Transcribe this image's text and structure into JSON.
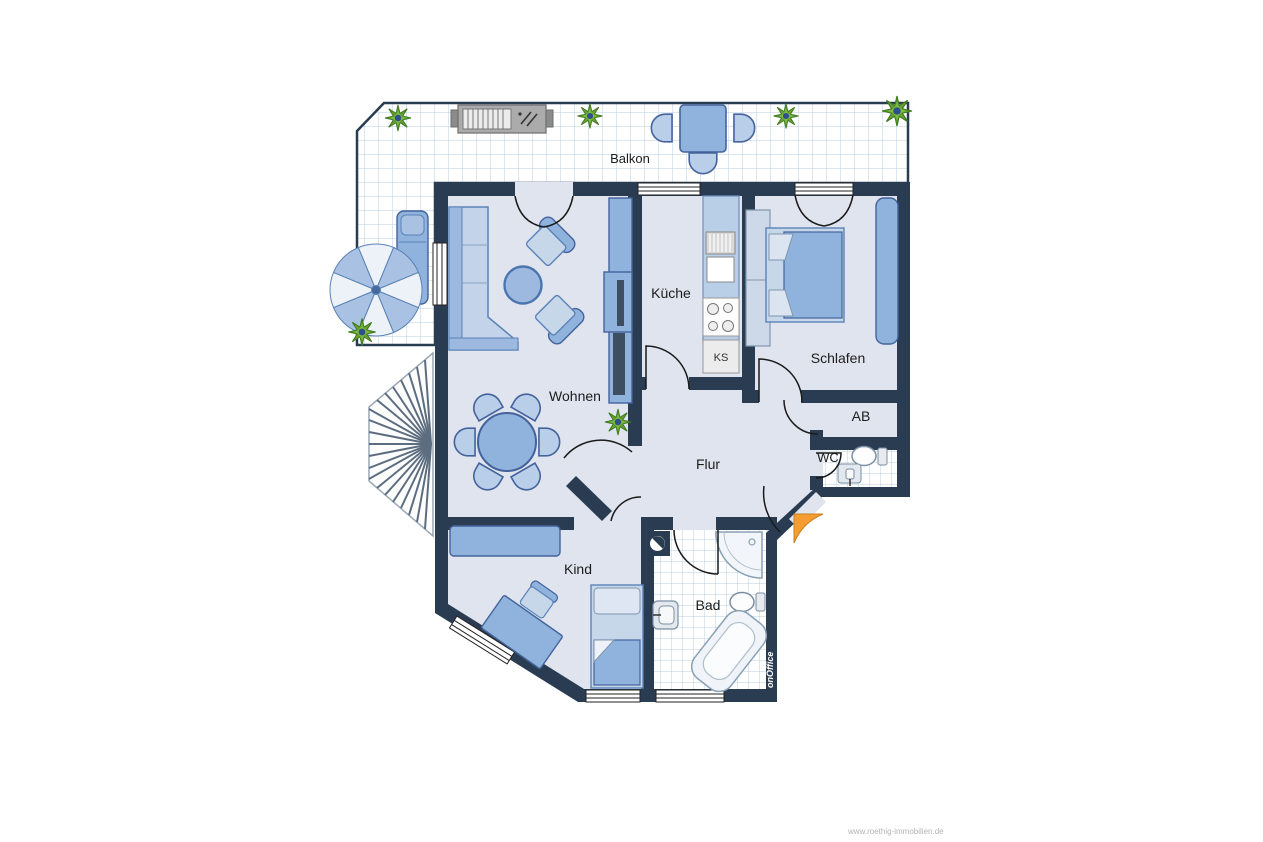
{
  "plan": {
    "labels": {
      "balcony": "Balkon",
      "living": "Wohnen",
      "kitchen": "Küche",
      "bedroom": "Schlafen",
      "hall": "Flur",
      "child": "Kind",
      "bath": "Bad",
      "storage": "AB",
      "wc": "WC",
      "fridge": "KS"
    },
    "branding": {
      "software_logo": "onOffice",
      "watermark": "www.roethig-immobilien.de"
    },
    "colors": {
      "wall": "#2a3c52",
      "floor": "#dfe4ee",
      "furniture": "#8fb3dc",
      "furniture_light": "#c7d7ea",
      "furniture_dark": "#44639c",
      "tile_line": "#c3d7e8",
      "plant_green": "#66a033",
      "entrance_arrow": "#f59d31"
    }
  }
}
